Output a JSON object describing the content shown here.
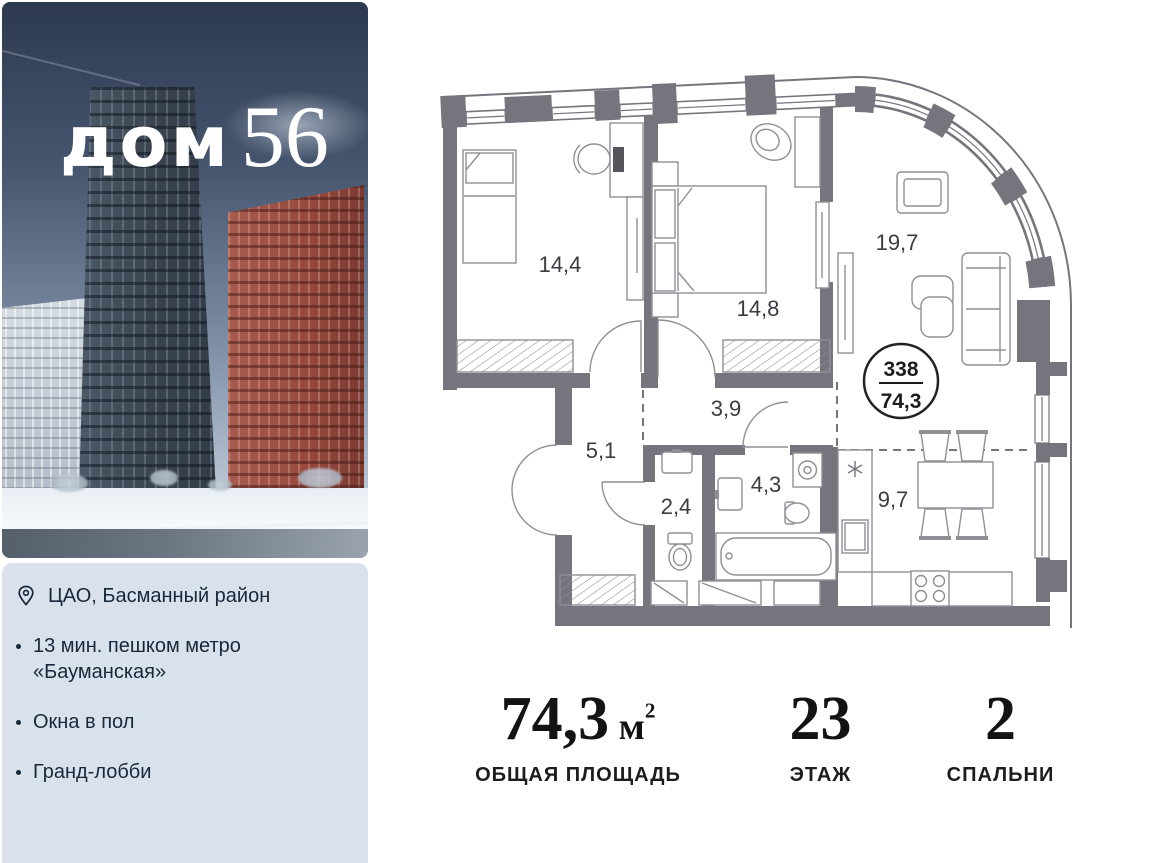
{
  "brand": {
    "logo_word": "дом",
    "logo_number": "56"
  },
  "info_panel": {
    "location_label": "ЦАО, Басманный район",
    "features": [
      "13 мин. пешком метро «Бауманская»",
      "Окна в пол",
      "Гранд-лобби"
    ]
  },
  "floor_plan": {
    "rooms": [
      {
        "id": "bedroom-1",
        "area": "14,4"
      },
      {
        "id": "bedroom-2",
        "area": "14,8"
      },
      {
        "id": "living-room",
        "area": "19,7"
      },
      {
        "id": "corridor",
        "area": "3,9"
      },
      {
        "id": "hall",
        "area": "5,1"
      },
      {
        "id": "wc",
        "area": "2,4"
      },
      {
        "id": "bathroom",
        "area": "4,3"
      },
      {
        "id": "kitchen-dining",
        "area": "9,7"
      }
    ],
    "unit_badge": {
      "number": "338",
      "area": "74,3"
    }
  },
  "stats": [
    {
      "number": "74,3",
      "unit": " м",
      "sup": "2",
      "label": "ОБЩАЯ ПЛОЩАДЬ"
    },
    {
      "number": "23",
      "unit": "",
      "sup": "",
      "label": "ЭТАЖ"
    },
    {
      "number": "2",
      "unit": "",
      "sup": "",
      "label": "СПАЛЬНИ"
    }
  ],
  "colors": {
    "wall": "#76757d",
    "panel_bg": "#d9e2ec",
    "text_dark": "#18273a"
  }
}
